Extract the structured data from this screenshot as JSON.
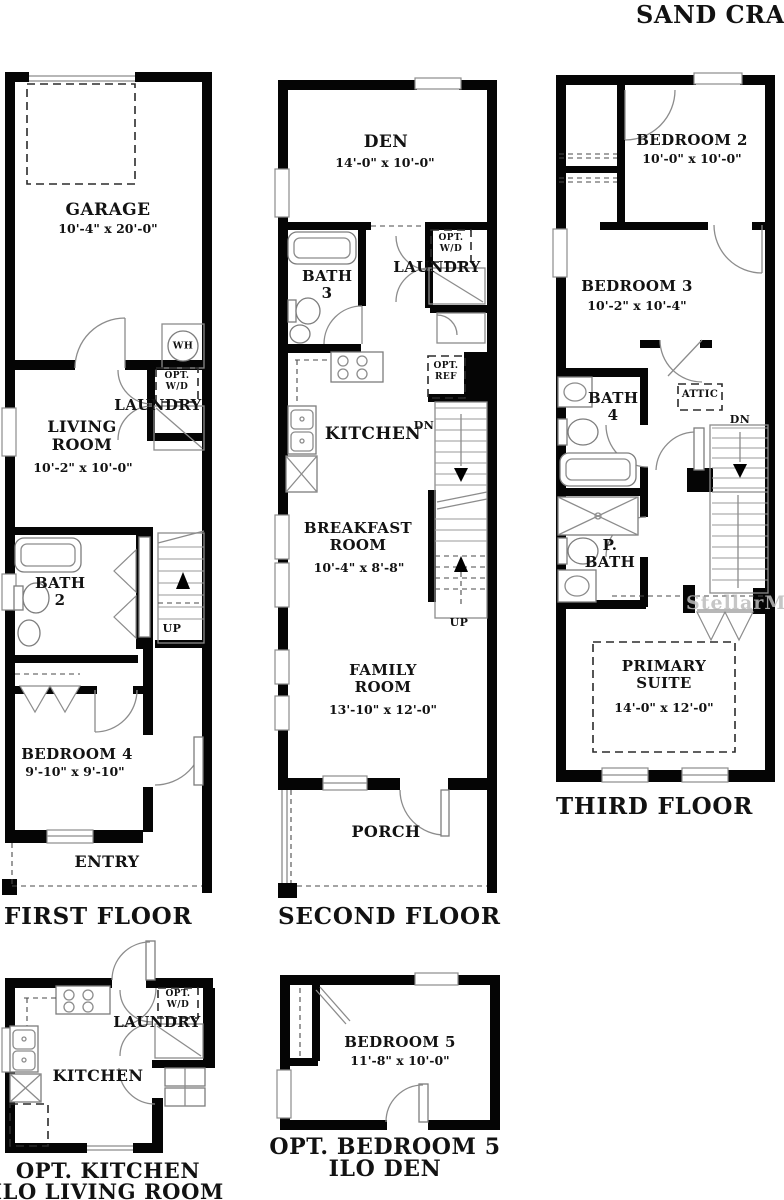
{
  "title": "SAND CRANE",
  "watermark": "StellarMLS",
  "floors": {
    "first": {
      "label": "FIRST FLOOR",
      "garage": {
        "name": "GARAGE",
        "dims": "10'-4\" x 20'-0\""
      },
      "water_heater": "WH",
      "laundry": {
        "opt": "OPT. W/D",
        "name": "LAUNDRY"
      },
      "living_room": {
        "name": "LIVING ROOM",
        "dims": "10'-2\" x 10'-0\""
      },
      "bath2": {
        "name": "BATH 2"
      },
      "stairs": {
        "up": "UP"
      },
      "bedroom4": {
        "name": "BEDROOM 4",
        "dims": "9'-10\" x 9'-10\""
      },
      "entry": {
        "name": "ENTRY"
      }
    },
    "second": {
      "label": "SECOND FLOOR",
      "den": {
        "name": "DEN",
        "dims": "14'-0\" x 10'-0\""
      },
      "bath3": {
        "name": "BATH 3"
      },
      "laundry": {
        "opt": "OPT. W/D",
        "name": "LAUNDRY"
      },
      "kitchen": {
        "name": "KITCHEN"
      },
      "ref": {
        "opt": "OPT. REF"
      },
      "stairs": {
        "dn": "DN",
        "up": "UP"
      },
      "breakfast": {
        "name": "BREAKFAST ROOM",
        "dims": "10'-4\" x 8'-8\""
      },
      "family": {
        "name": "FAMILY ROOM",
        "dims": "13'-10\" x 12'-0\""
      },
      "porch": {
        "name": "PORCH"
      }
    },
    "third": {
      "label": "THIRD FLOOR",
      "bedroom2": {
        "name": "BEDROOM 2",
        "dims": "10'-0\" x 10'-0\""
      },
      "bedroom3": {
        "name": "BEDROOM 3",
        "dims": "10'-2\" x 10'-4\""
      },
      "bath4": {
        "name": "BATH 4"
      },
      "attic": "ATTIC",
      "stairs": {
        "dn": "DN"
      },
      "primary_bath": {
        "name": "P. BATH"
      },
      "primary_suite": {
        "name": "PRIMARY SUITE",
        "dims": "14'-0\" x 12'-0\""
      }
    },
    "opt_kitchen": {
      "label_line1": "OPT. KITCHEN",
      "label_line2": "ILO LIVING ROOM",
      "kitchen": {
        "name": "KITCHEN"
      },
      "laundry": {
        "opt": "OPT. W/D",
        "name": "LAUNDRY"
      }
    },
    "opt_bedroom5": {
      "label_line1": "OPT. BEDROOM 5",
      "label_line2": "ILO DEN",
      "bedroom5": {
        "name": "BEDROOM 5",
        "dims": "11'-8\" x 10'-0\""
      }
    }
  }
}
